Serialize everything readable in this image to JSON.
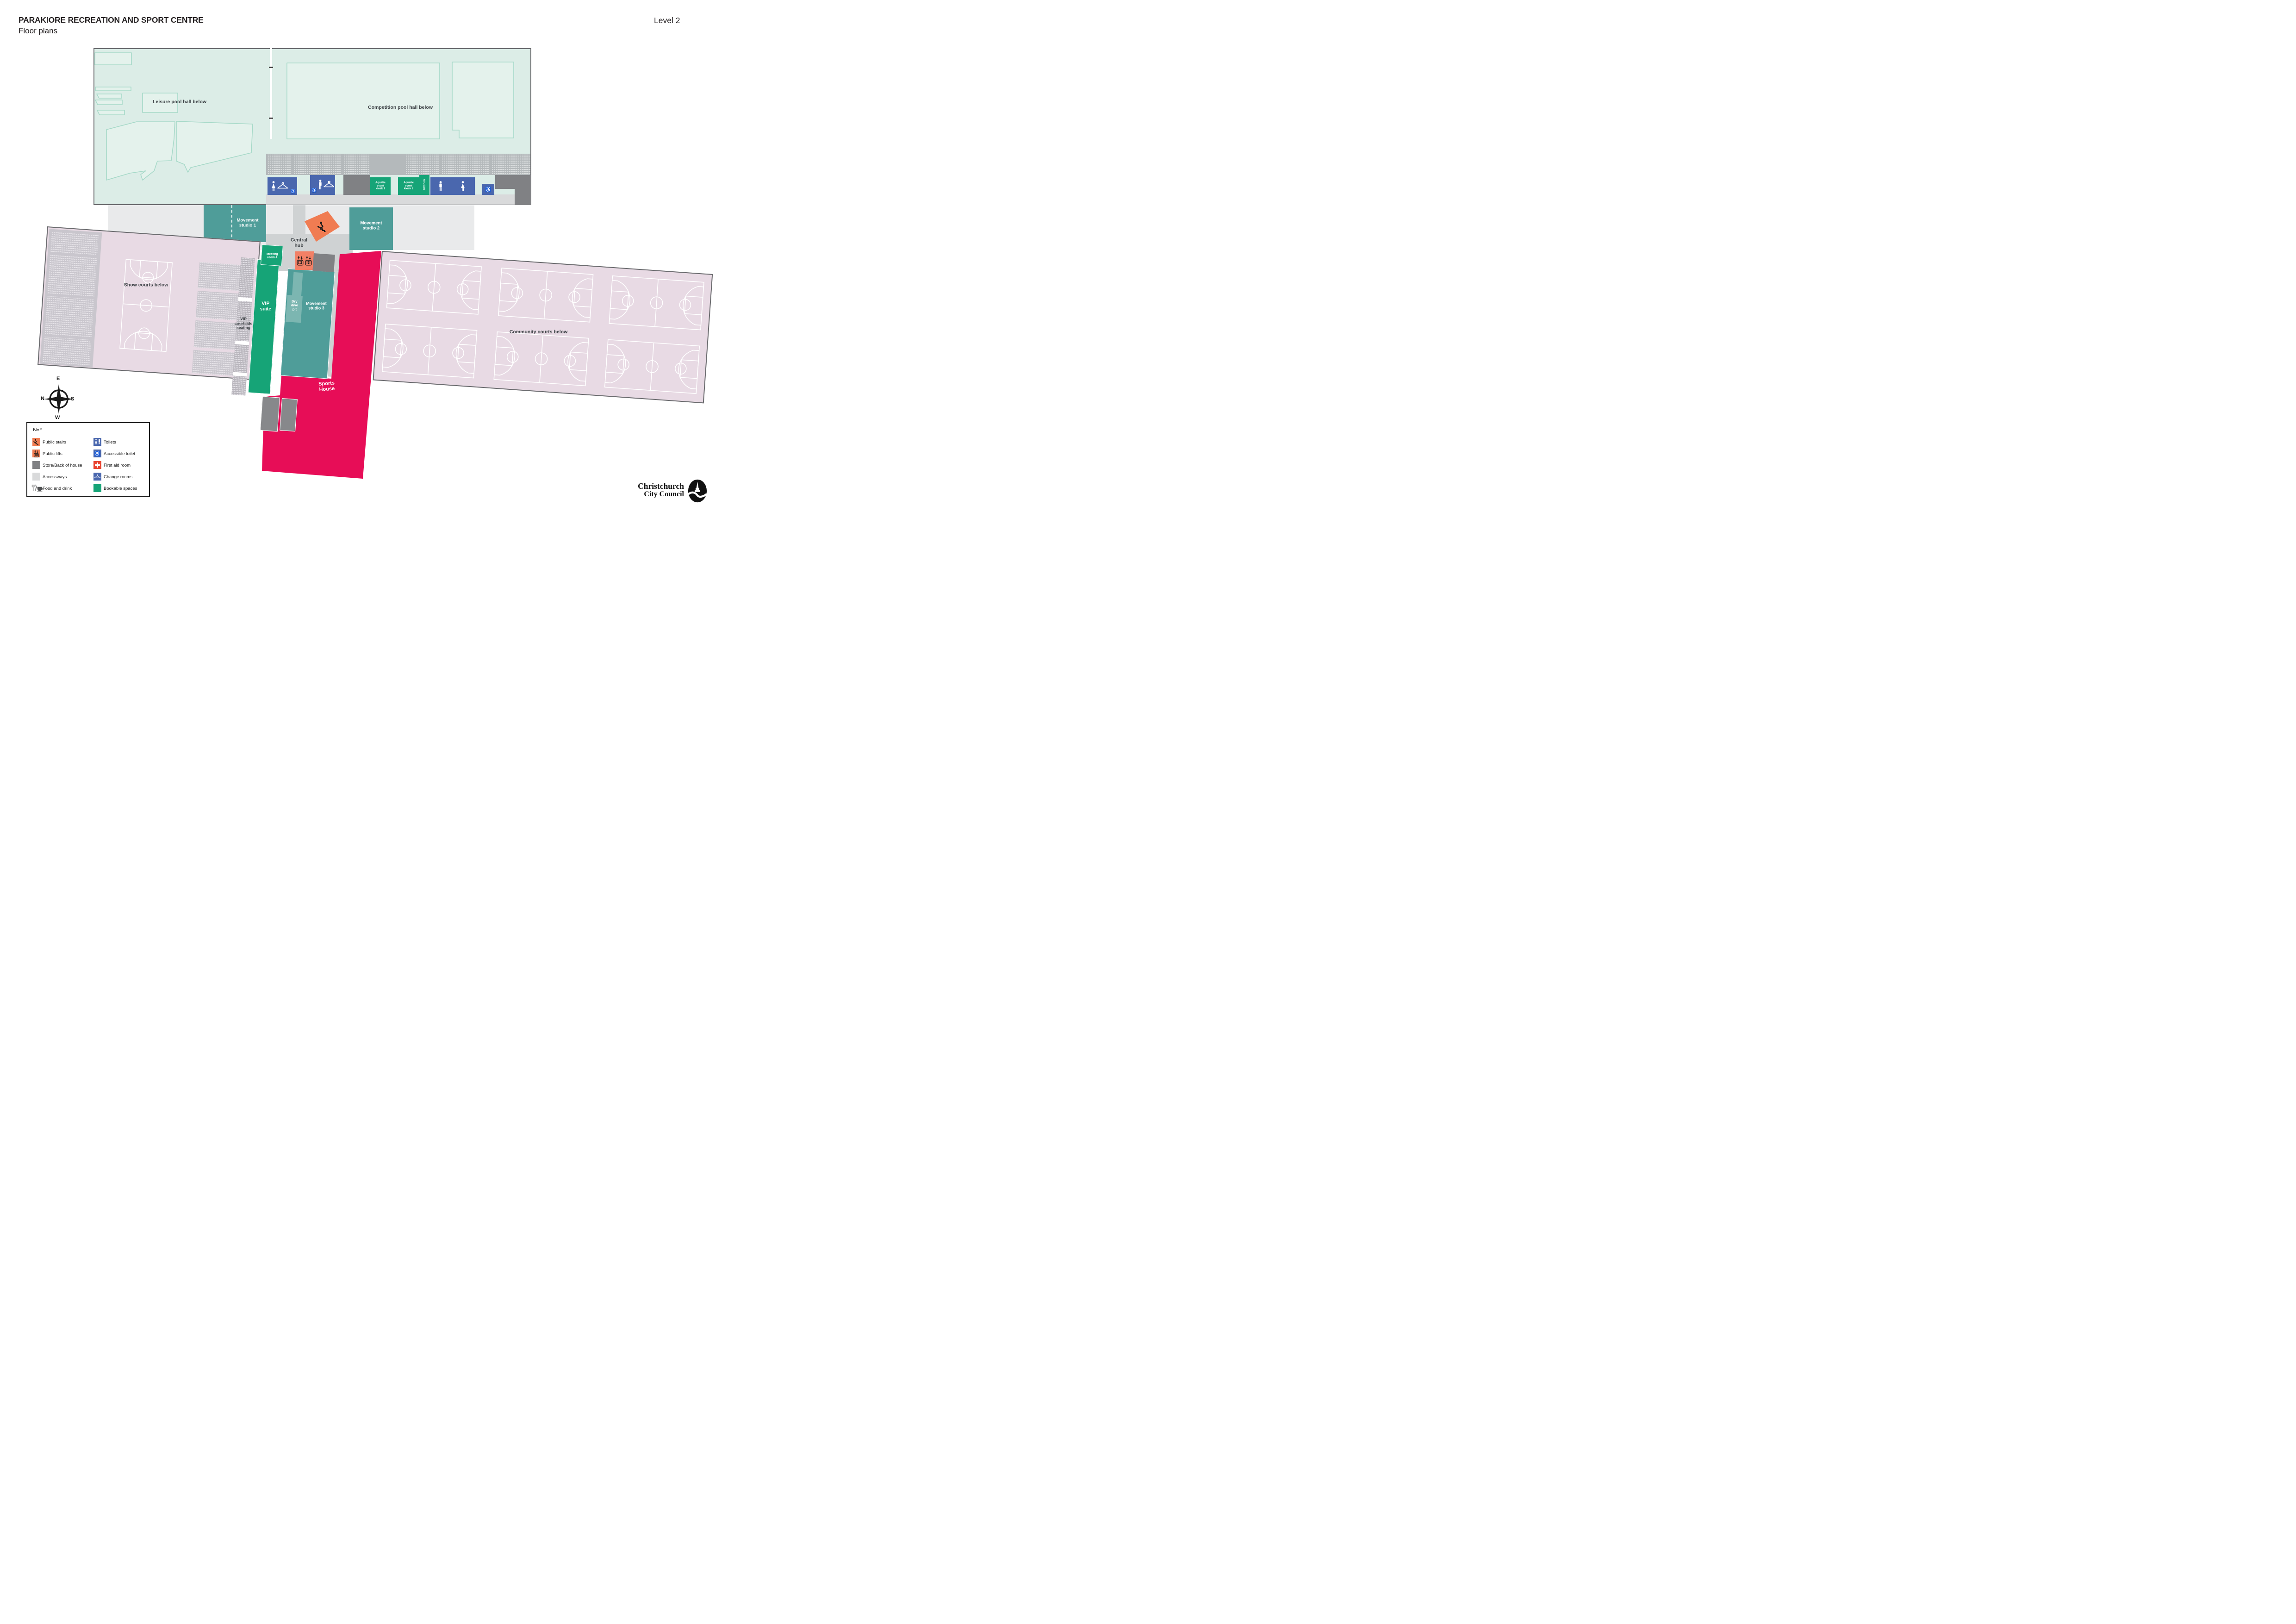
{
  "header": {
    "title": "PARAKIORE RECREATION AND SPORT CENTRE",
    "subtitle": "Floor plans",
    "level": "Level 2"
  },
  "plan": {
    "leisure_pool_label": "Leisure pool hall below",
    "competition_pool_label": "Competition pool hall below",
    "movement_studio_1": "Movement\nstudio 1",
    "movement_studio_2": "Movement\nstudio 2",
    "movement_studio_3": "Movement\nstudio 3",
    "central_hub": "Central\nhub",
    "meeting_room_4": "Meeting\nroom 4",
    "aquatic_event_kiosk_1": "Aquatic\nevent\nkiosk 1",
    "aquatic_event_kiosk_2": "Aquatic\nevent\nkiosk 2",
    "kitchen": "Kitchen",
    "vip_courtside_seating": "VIP\ncourtside\nseating",
    "vip_suite": "VIP\nsuite",
    "dry_dive_pit": "Dry\ndive\npit",
    "sports_house": "Sports\nHouse",
    "show_courts": "Show courts below",
    "community_courts": "Community courts below"
  },
  "key": {
    "title": "KEY",
    "left": [
      {
        "icon": "public-stairs",
        "label": "Public stairs"
      },
      {
        "icon": "public-lifts",
        "label": "Public lifts"
      },
      {
        "icon": "store-back-of-house",
        "label": "Store/Back of house"
      },
      {
        "icon": "accessways",
        "label": "Accessways"
      },
      {
        "icon": "food-and-drink",
        "label": "Food and drink"
      }
    ],
    "right": [
      {
        "icon": "toilets",
        "label": "Toilets"
      },
      {
        "icon": "accessible-toilet",
        "label": "Accessible toilet"
      },
      {
        "icon": "first-aid-room",
        "label": "First aid room"
      },
      {
        "icon": "change-rooms",
        "label": "Change rooms"
      },
      {
        "icon": "bookable-spaces",
        "label": "Bookable spaces"
      }
    ]
  },
  "compass": {
    "top": "E",
    "left": "N",
    "right": "S",
    "bottom": "W"
  },
  "logo": {
    "line1": "Christchurch",
    "line2": "City Council"
  },
  "icons": {
    "wheelchair": "♿",
    "stairs": "person-descending-stairs",
    "lift": "up-down-arrows-over-lift-car",
    "hanger": "coat-hanger",
    "male": "male-figure",
    "female": "female-figure",
    "first_aid": "white-cross",
    "food": "fork-knife-and-cup",
    "compass": "four-point-star"
  },
  "colors": {
    "mint": "#DCEDE7",
    "pool_outline": "#A6D9C8",
    "pool_fill": "#E4F2EC",
    "concourse": "#B4B9BB",
    "blue": "#4A67AE",
    "green": "#16A477",
    "teal": "#4F9D99",
    "teal_light": "#7CB6B1",
    "orange": "#F07C52",
    "lift_orange": "#F28066",
    "red": "#E70D57",
    "first_aid": "#E8432F",
    "pink": "#E8DAE4",
    "store_grey": "#808184",
    "accessway": "#E9EAEB",
    "corridor": "#CFD2D3",
    "label_dark": "#3E4347",
    "border_grey": "#6A6B6E"
  }
}
